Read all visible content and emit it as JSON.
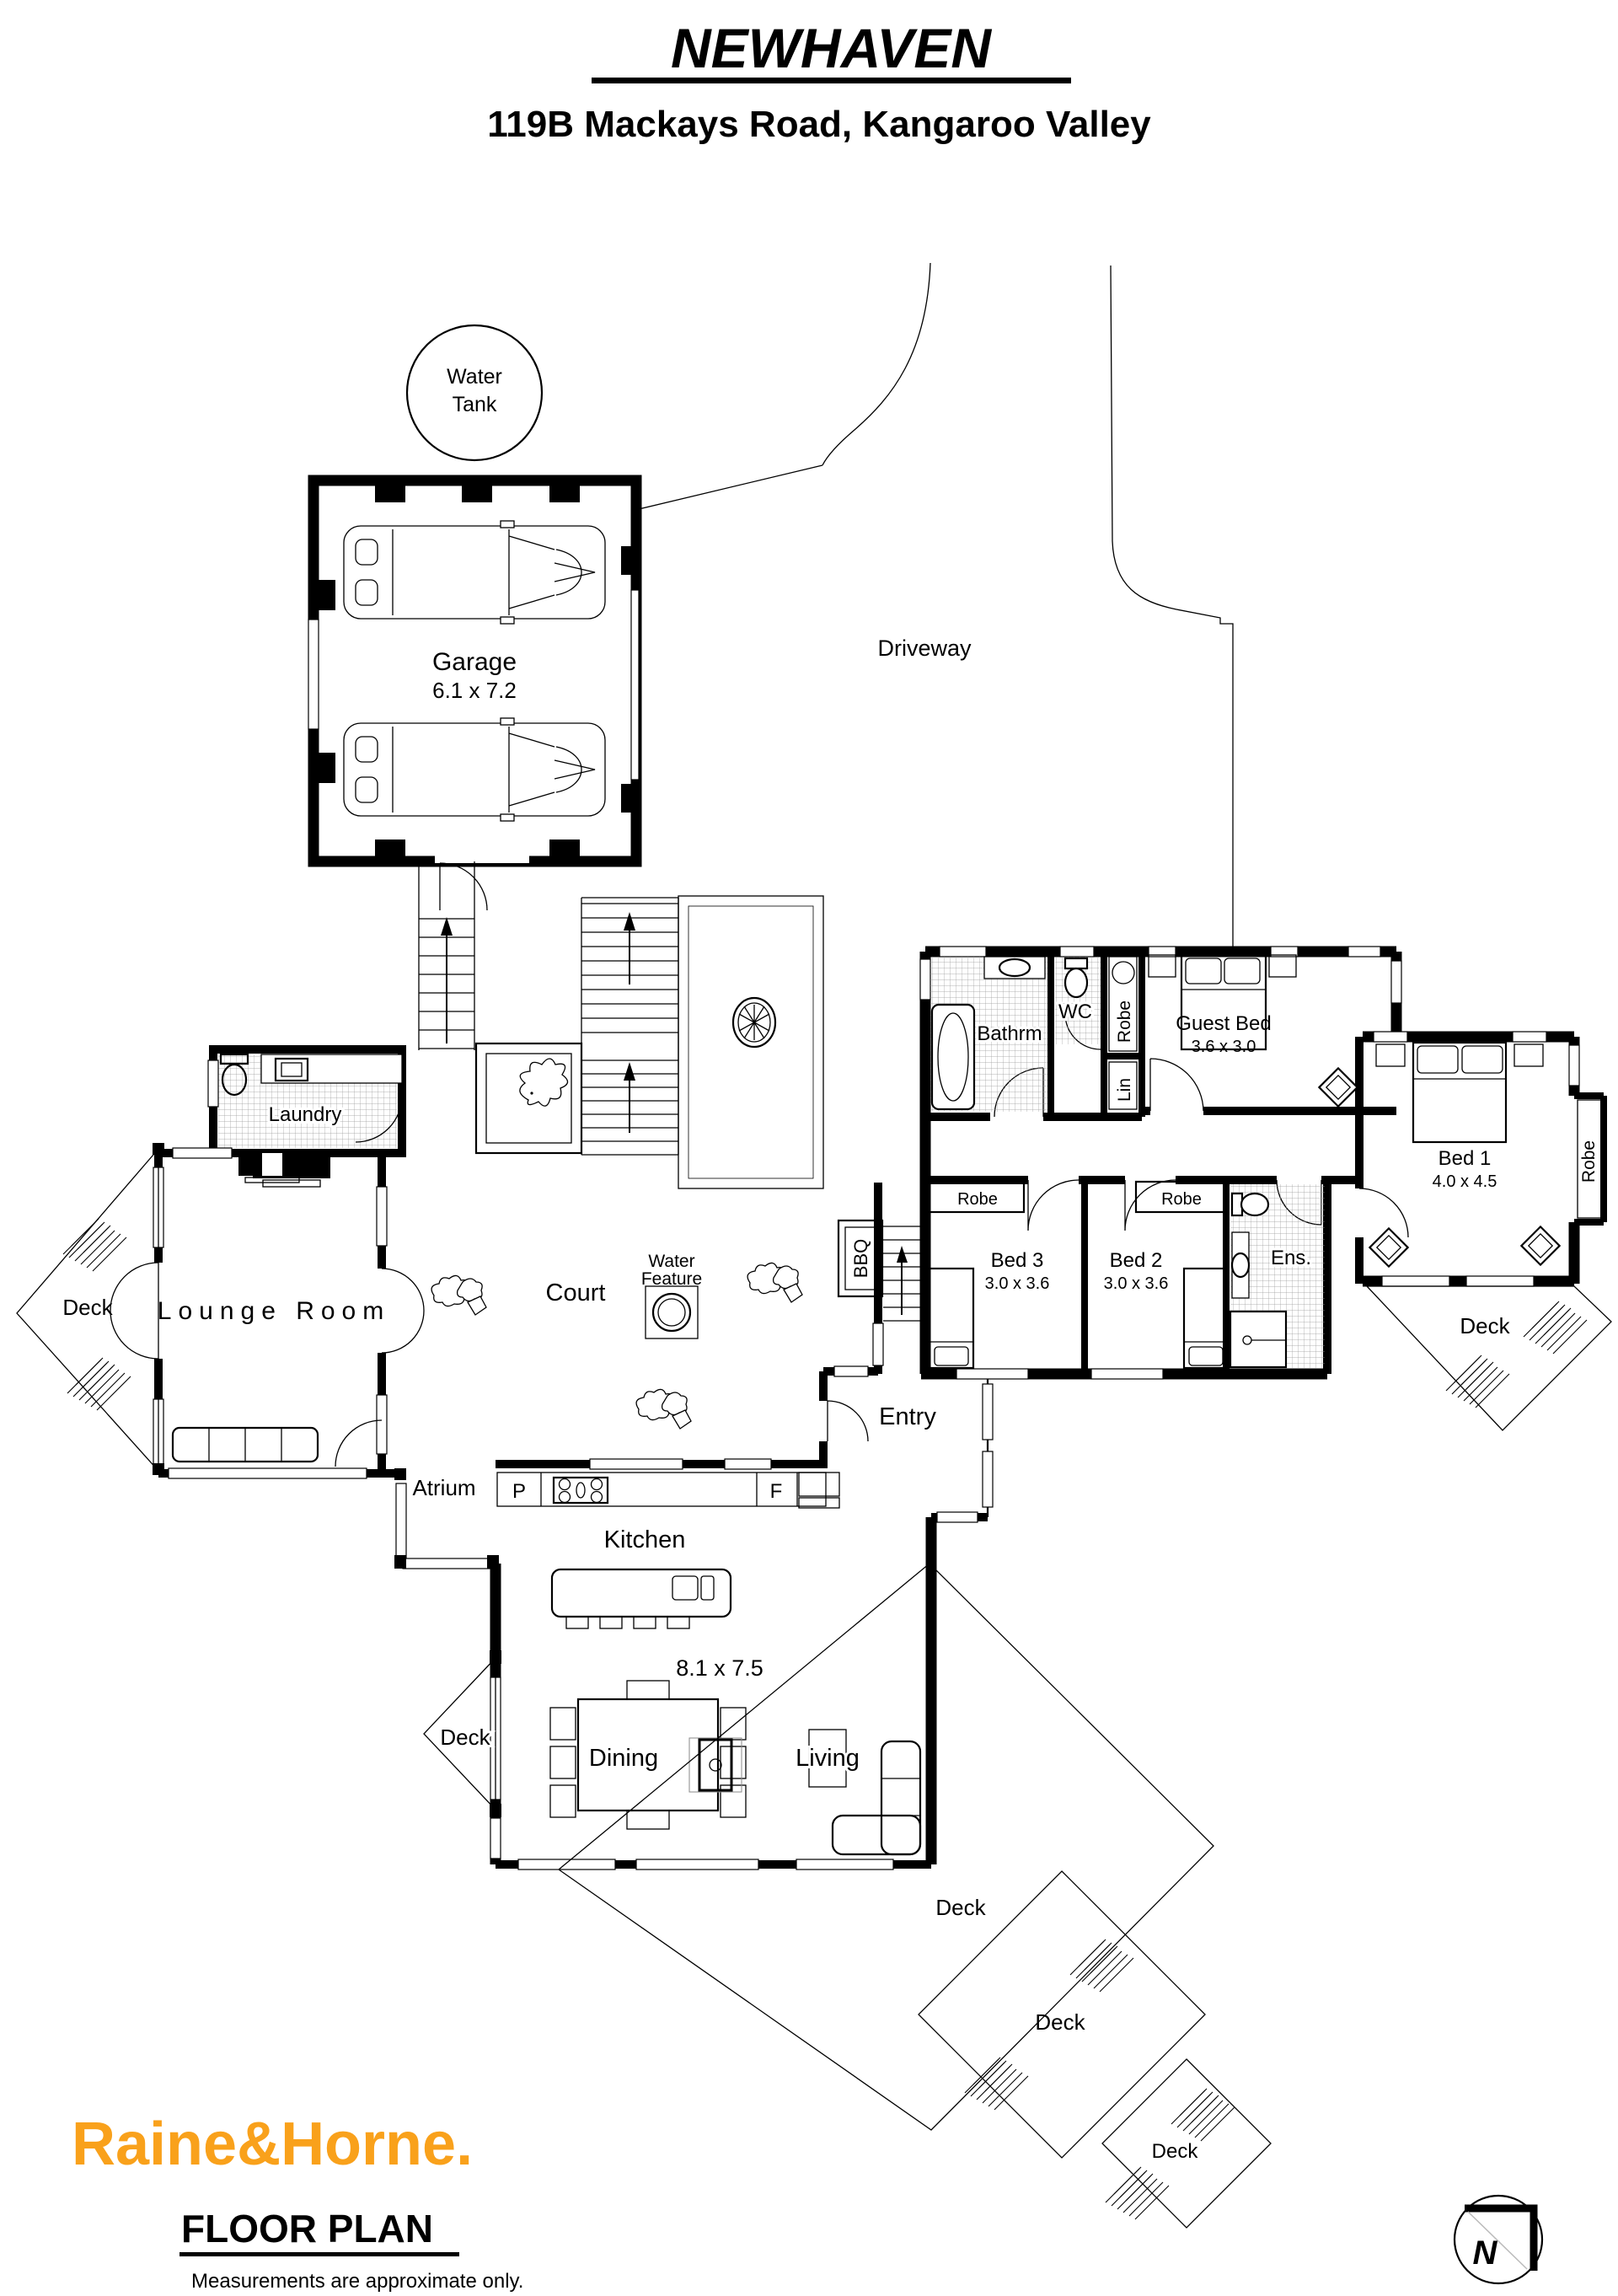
{
  "header": {
    "title": "NEWHAVEN",
    "address": "119B Mackays Road, Kangaroo Valley"
  },
  "site": {
    "water_tank": {
      "line1": "Water",
      "line2": "Tank"
    },
    "garage": {
      "name": "Garage",
      "dims": "6.1 x 7.2"
    },
    "driveway": "Driveway"
  },
  "rooms": {
    "laundry": "Laundry",
    "lounge": "Lounge Room",
    "atrium": "Atrium",
    "court": "Court",
    "water_feature": {
      "line1": "Water",
      "line2": "Feature"
    },
    "bbq": "BBQ",
    "entry": "Entry",
    "kitchen": {
      "name": "Kitchen",
      "dims": "8.1 x 7.5",
      "pantry": "P",
      "fridge": "F"
    },
    "dining": "Dining",
    "living": "Living",
    "bathroom": "Bathrm",
    "wc": "WC",
    "robe": "Robe",
    "linen": "Lin",
    "ensuite": "Ens.",
    "guest_bed": {
      "name": "Guest Bed",
      "dims": "3.6 x 3.0"
    },
    "bed1": {
      "name": "Bed 1",
      "dims": "4.0 x 4.5"
    },
    "bed2": {
      "name": "Bed 2",
      "dims": "3.0 x 3.6"
    },
    "bed3": {
      "name": "Bed 3",
      "dims": "3.0 x 3.6"
    },
    "deck": "Deck"
  },
  "footer": {
    "brand": "Raine&Horne.",
    "brand_color": "#F9A11B",
    "plan_title": "FLOOR PLAN",
    "disclaimer": "Measurements are approximate only.",
    "compass": "N"
  }
}
